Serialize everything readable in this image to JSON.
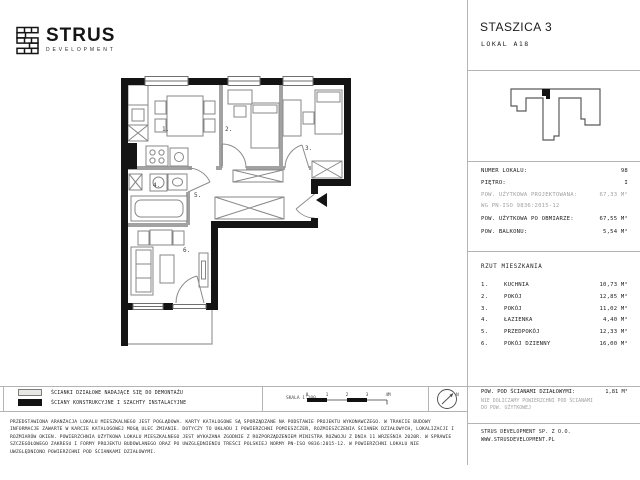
{
  "logo": {
    "brand": "STRUS",
    "sub": "DEVELOPMENT"
  },
  "project": {
    "title": "STASZICA 3",
    "unit": "LOKAL A18"
  },
  "details": {
    "rows": [
      {
        "label": "NUMER LOKALU:",
        "value": "98"
      },
      {
        "label": "PIĘTRO:",
        "value": "I"
      },
      {
        "label": "POW. UŻYTKOWA PROJEKTOWANA:",
        "value": "67,33 M²"
      },
      {
        "label": "WG PN-ISO 9836:2015-12",
        "value": ""
      },
      {
        "label": "POW. UŻYTKOWA PO OBMIARZE:",
        "value": "67,55 M²"
      },
      {
        "label": "POW. BALKONU:",
        "value": "5,54 M²"
      }
    ]
  },
  "rooms": {
    "heading": "RZUT MIESZKANIA",
    "items": [
      {
        "num": "1.",
        "name": "KUCHNIA",
        "area": "10,73 M²"
      },
      {
        "num": "2.",
        "name": "POKÓJ",
        "area": "12,85 M²"
      },
      {
        "num": "3.",
        "name": "POKÓJ",
        "area": "11,02 M²"
      },
      {
        "num": "4.",
        "name": "ŁAZIENKA",
        "area": "4,40 M²"
      },
      {
        "num": "5.",
        "name": "PRZEDPOKÓJ",
        "area": "12,33 M²"
      },
      {
        "num": "6.",
        "name": "POKÓJ DZIENNY",
        "area": "16,00 M²"
      }
    ]
  },
  "partition_section": {
    "label": "POW. POD ŚCIANAMI DZIAŁOWYMI:",
    "value": "1,81 M²",
    "note": "NIE DOLICZAMY POWIERZCHNI POD ŚCIANAMI DO POW. UŻYTKOWEJ"
  },
  "company": {
    "name": "STRUS DEVELOPMENT SP. Z O.O.",
    "website": "WWW.STRUSDEVELOPMENT.PL"
  },
  "legend": {
    "items": [
      {
        "swatch": "partition",
        "label": "ŚCIANKI DZIAŁOWE NADAJĄCE SIĘ DO DEMONTAŻU"
      },
      {
        "swatch": "structural",
        "label": "ŚCIANY KONSTRUKCYJNE I SZACHTY INSTALACYJNE"
      }
    ]
  },
  "scale": {
    "label": "SKALA 1:100",
    "ticks": [
      "0",
      "1",
      "2",
      "3",
      "4M"
    ]
  },
  "compass": {
    "north": "N"
  },
  "plan": {
    "room_labels": [
      "1.",
      "2.",
      "3.",
      "4.",
      "5.",
      "6."
    ]
  },
  "disclaimer": {
    "lines": [
      "PRZEDSTAWIONA ARANŻACJA LOKALU MIESZKALNEGO JEST POGLĄDOWA. KARTY KATALOGOWE SĄ SPORZĄDZANE NA PODSTAWIE PROJEKTU WYKONAWCZEGO. W TRAKCIE BUDOWY",
      "INFORMACJE ZAWARTE W KARCIE KATALOGOWEJ MOGĄ ULEC ZMIANIE. DOTYCZY TO UKŁADU I POWIERZCHNI POMIESZCZEŃ, ROZMIESZCZENIA ŚCIANEK DZIAŁOWYCH, LOKALIZACJI I",
      "ROZMIARÓW OKIEN. POWIERZCHNIA UŻYTKOWA LOKALU MIESZKALNEGO JEST WYKAZANA ZGODNIE Z ROZPORZĄDZENIEM MINISTRA ROZWOJU Z DNIA 11 WRZEŚNIA 2020R. W SPRAWIE",
      "SZCZEGÓŁOWEGO ZAKRESU I FORMY PROJEKTU BUDOWLANEGO ORAZ PO UWZGLĘDNIENIU TREŚCI POLSKIEJ NORMY PN-ISO 9836:2015-12. W POWIERZCHNI LOKALU NIE",
      "UWZGLĘDNIONO POWIERZCHNI POD ŚCIANKAMI DZIAŁOWYMI."
    ]
  },
  "colors": {
    "wall": "#141414",
    "partition_wall": "#a2a2a2",
    "muted": "#a2a2a2",
    "line": "#b4b4b4"
  }
}
